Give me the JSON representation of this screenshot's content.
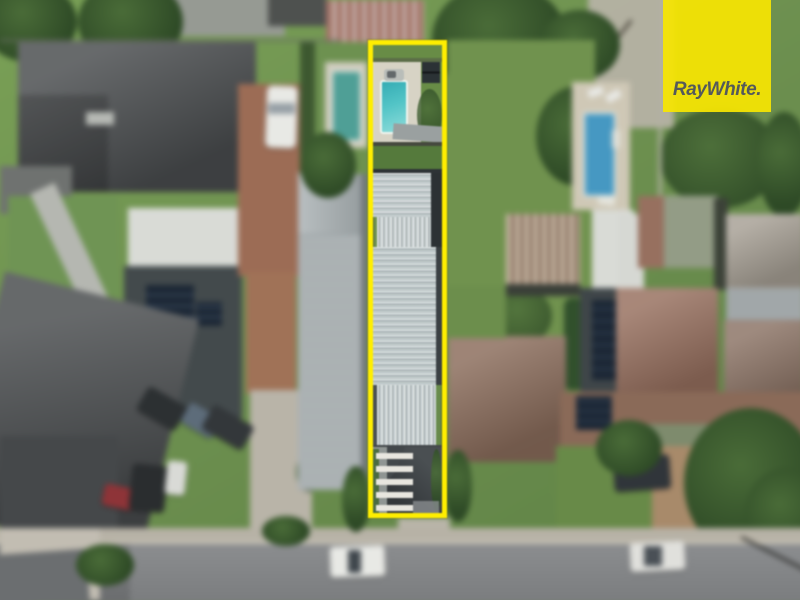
{
  "brand": {
    "logo_text": "RayWhite."
  },
  "annotation": {
    "kind": "property-boundary-highlight",
    "shape": "tall-narrow-rectangle",
    "color": "#FFEE00"
  },
  "scene": {
    "type": "aerial-photograph-residential-street",
    "features": [
      "highlighted-lot-boundary",
      "backyard-swimming-pool",
      "pool-spa",
      "garden-shed",
      "long-metal-roof-building",
      "front-house-dark-roof",
      "white-balcony-bars",
      "neighbour-pool-left",
      "neighbour-pool-right",
      "sun-lounges",
      "lawns",
      "trees",
      "driveways",
      "parked-cars",
      "white-van",
      "red-car",
      "black-suv",
      "white-ute",
      "solar-panel-roofs",
      "rusty-shed-roof",
      "street",
      "footpath",
      "power-line",
      "ray-white-logo"
    ]
  },
  "palette": {
    "logo_yellow": "#F6E502",
    "logo_text": "#54595B",
    "boundary_yellow": "#FFEE00",
    "lawn": "#6E9150",
    "lawn_dark": "#557A3C",
    "tree_dark": "#2E4A26",
    "tree_mid": "#4A6C38",
    "metal_roof": "#C2CBCC",
    "dark_roof": "#4A4D4F",
    "charcoal": "#2E3336",
    "white_roof": "#D9DBD6",
    "brown_roof": "#8B6D5C",
    "red_brown_roof": "#97705F",
    "sage_roof": "#899377",
    "rust_light": "#C4B5A2",
    "rust_dark": "#8A7260",
    "weathered_roof": "#A7A095",
    "concrete": "#B9B4A8",
    "asphalt": "#85878A",
    "brick_drive": "#9C6C55",
    "paver_drive": "#A88A6A",
    "pool_turquoise": "#45BCC0",
    "pool_blue": "#4698C2",
    "pool_teal": "#4F9F96",
    "pool_deck": "#D7D3C5",
    "car_white": "#E8E9E5",
    "car_red": "#8E3438",
    "car_black": "#2A2D2F",
    "solar": "#1C2735"
  }
}
